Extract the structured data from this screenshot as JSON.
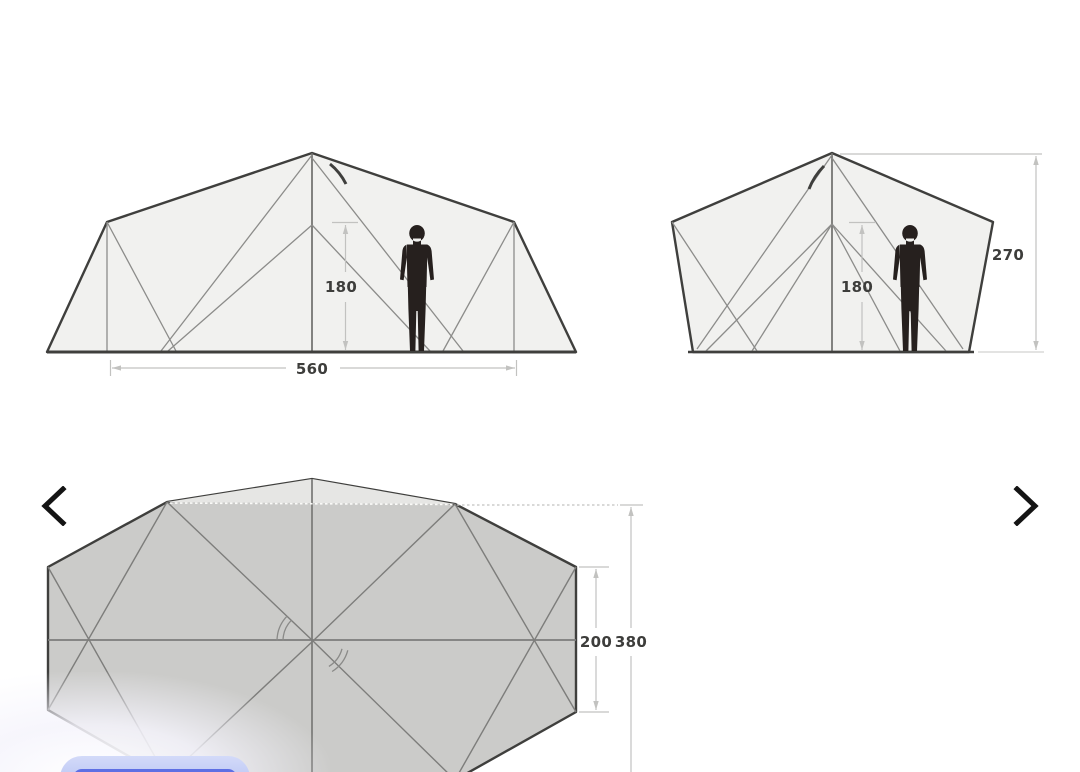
{
  "viewer": {
    "background_color": "#ffffff",
    "nav": {
      "prev_icon": "chevron-left-icon",
      "next_icon": "chevron-right-icon"
    },
    "overlay_chip": {
      "outer_color": "#c7cff6",
      "inner_color": "#5e6fe4"
    }
  },
  "diagram": {
    "title": "tent dimension diagrams",
    "stroke_color": "#3f3f3d",
    "panel_fill": "#f1f1ef",
    "floor_fill": "#cbcbc9",
    "dimension_line_color": "#c2c2c0",
    "label_color": "#3d3d3b",
    "views": {
      "side_view": {
        "height_cm": "180",
        "length_cm": "560"
      },
      "front_view": {
        "inner_height_cm": "180",
        "peak_height_cm": "270"
      },
      "floor_plan": {
        "inner_depth_cm": "200",
        "total_depth_cm": "380"
      }
    }
  }
}
